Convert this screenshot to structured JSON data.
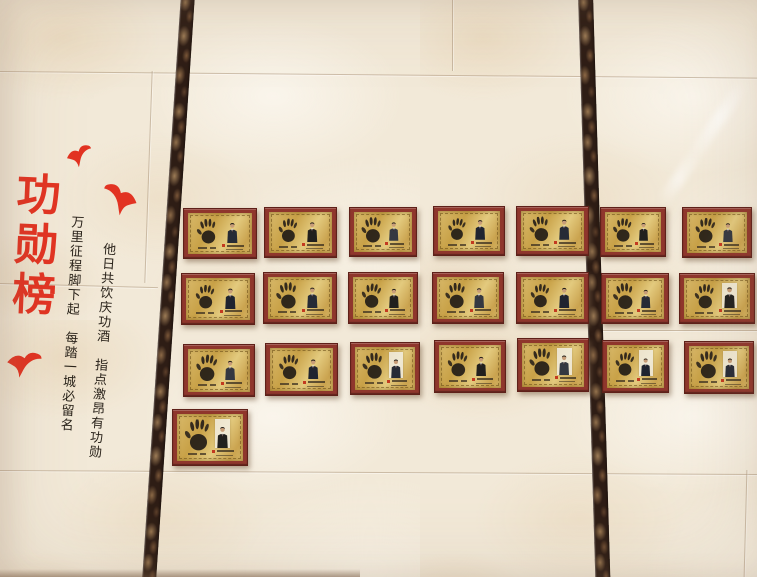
{
  "scene": {
    "title": "功勋榜",
    "couplets": {
      "right_column": "他日共饮庆功酒　指点激昂有功勋",
      "left_column": "万里征程脚下起　每踏一城必留名"
    }
  },
  "colors": {
    "accent_red": "#e23322",
    "ink_black": "#2b241c",
    "frame_red": "#8f362c",
    "plate_gold": "#cfa94e",
    "marble_dark": "#2e1d15",
    "wall_cream": "#f2e9d8"
  },
  "birds": [
    {
      "x": 66,
      "y": 145,
      "w": 27,
      "h": 22,
      "rot": -10,
      "flip": false
    },
    {
      "x": 101,
      "y": 184,
      "w": 37,
      "h": 31,
      "rot": 12,
      "flip": true
    },
    {
      "x": 6,
      "y": 350,
      "w": 36,
      "h": 28,
      "rot": 6,
      "flip": false
    }
  ],
  "board": {
    "plaque_count": 22,
    "rows": [
      7,
      7,
      7,
      1
    ],
    "plaques": [
      {
        "x": 183,
        "y": 208,
        "w": 74,
        "h": 51,
        "photo_bg": "gold",
        "hand_rot": -6,
        "hand_scale": 1.0,
        "suit": "#262b36"
      },
      {
        "x": 264,
        "y": 207,
        "w": 73,
        "h": 51,
        "photo_bg": "gold",
        "hand_rot": 4,
        "hand_scale": 0.95,
        "suit": "#21201e"
      },
      {
        "x": 349,
        "y": 207,
        "w": 68,
        "h": 50,
        "photo_bg": "gold",
        "hand_rot": -3,
        "hand_scale": 1.05,
        "suit": "#343841"
      },
      {
        "x": 433,
        "y": 206,
        "w": 72,
        "h": 50,
        "photo_bg": "gold",
        "hand_rot": 7,
        "hand_scale": 0.9,
        "suit": "#1f2430"
      },
      {
        "x": 516,
        "y": 206,
        "w": 73,
        "h": 50,
        "photo_bg": "gold",
        "hand_rot": -8,
        "hand_scale": 1.02,
        "suit": "#262b36"
      },
      {
        "x": 600,
        "y": 207,
        "w": 66,
        "h": 50,
        "photo_bg": "gold",
        "hand_rot": 2,
        "hand_scale": 0.97,
        "suit": "#21201e"
      },
      {
        "x": 682,
        "y": 207,
        "w": 70,
        "h": 51,
        "photo_bg": "gold",
        "hand_rot": 5,
        "hand_scale": 1.0,
        "suit": "#343841"
      },
      {
        "x": 181,
        "y": 273,
        "w": 74,
        "h": 52,
        "photo_bg": "gold",
        "hand_rot": 3,
        "hand_scale": 0.93,
        "suit": "#1f2430"
      },
      {
        "x": 263,
        "y": 272,
        "w": 74,
        "h": 52,
        "photo_bg": "gold",
        "hand_rot": -5,
        "hand_scale": 1.04,
        "suit": "#262b36"
      },
      {
        "x": 348,
        "y": 272,
        "w": 70,
        "h": 52,
        "photo_bg": "gold",
        "hand_rot": 6,
        "hand_scale": 0.96,
        "suit": "#21201e"
      },
      {
        "x": 432,
        "y": 272,
        "w": 72,
        "h": 52,
        "photo_bg": "gold",
        "hand_rot": -2,
        "hand_scale": 1.0,
        "suit": "#343841"
      },
      {
        "x": 516,
        "y": 272,
        "w": 73,
        "h": 52,
        "photo_bg": "gold",
        "hand_rot": 4,
        "hand_scale": 0.92,
        "suit": "#1f2430"
      },
      {
        "x": 601,
        "y": 273,
        "w": 68,
        "h": 51,
        "photo_bg": "gold",
        "hand_rot": -7,
        "hand_scale": 1.05,
        "suit": "#262b36"
      },
      {
        "x": 679,
        "y": 273,
        "w": 76,
        "h": 51,
        "photo_bg": "light",
        "hand_rot": 1,
        "hand_scale": 0.98,
        "suit": "#21201e"
      },
      {
        "x": 183,
        "y": 344,
        "w": 72,
        "h": 53,
        "photo_bg": "gold",
        "hand_rot": 5,
        "hand_scale": 1.02,
        "suit": "#343841"
      },
      {
        "x": 265,
        "y": 343,
        "w": 73,
        "h": 53,
        "photo_bg": "gold",
        "hand_rot": 2,
        "hand_scale": 0.94,
        "suit": "#1f2430"
      },
      {
        "x": 350,
        "y": 342,
        "w": 70,
        "h": 53,
        "photo_bg": "light",
        "hand_rot": -6,
        "hand_scale": 1.0,
        "suit": "#262b36"
      },
      {
        "x": 434,
        "y": 340,
        "w": 72,
        "h": 53,
        "photo_bg": "gold",
        "hand_rot": 3,
        "hand_scale": 0.96,
        "suit": "#21201e"
      },
      {
        "x": 517,
        "y": 338,
        "w": 72,
        "h": 54,
        "photo_bg": "light",
        "hand_rot": -4,
        "hand_scale": 1.03,
        "suit": "#343841"
      },
      {
        "x": 602,
        "y": 340,
        "w": 67,
        "h": 53,
        "photo_bg": "light",
        "hand_rot": 6,
        "hand_scale": 0.9,
        "suit": "#1f2430"
      },
      {
        "x": 684,
        "y": 341,
        "w": 70,
        "h": 53,
        "photo_bg": "light",
        "hand_rot": -2,
        "hand_scale": 1.05,
        "suit": "#262b36"
      },
      {
        "x": 172,
        "y": 409,
        "w": 76,
        "h": 57,
        "photo_bg": "light",
        "hand_rot": 0,
        "hand_scale": 1.1,
        "suit": "#21201e"
      }
    ]
  }
}
